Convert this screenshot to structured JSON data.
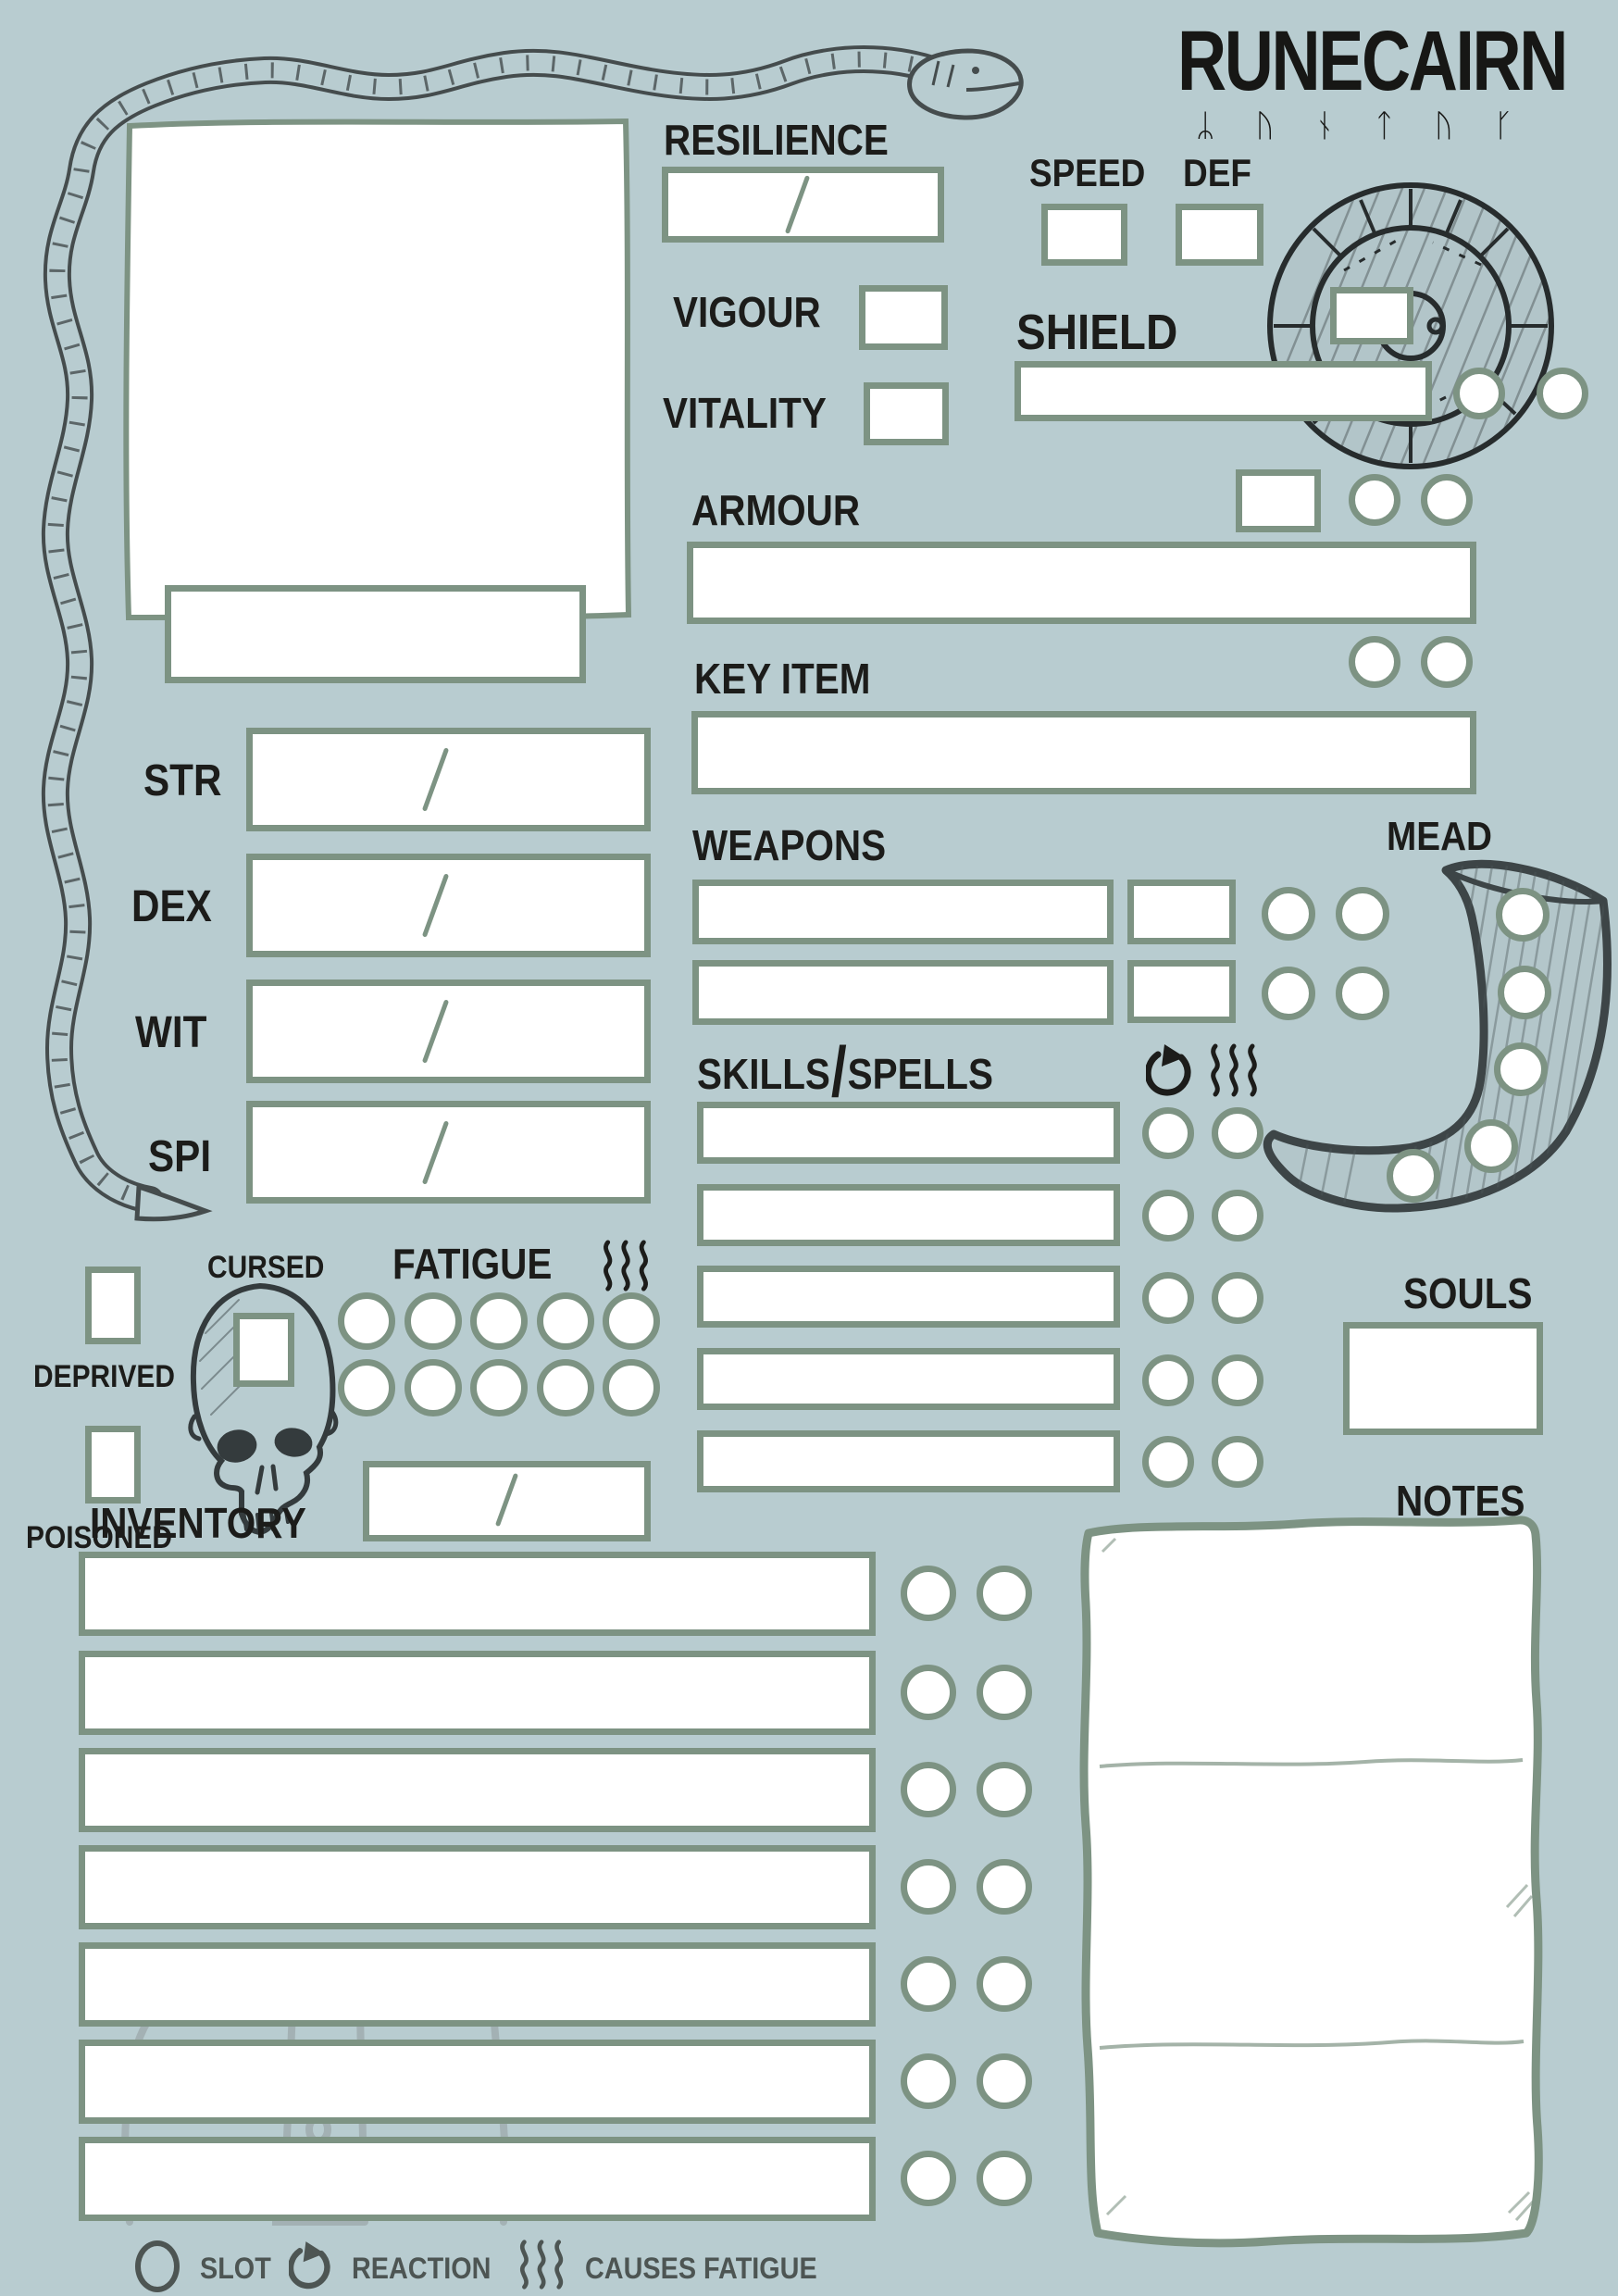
{
  "logo": {
    "title": "RUNECAIRN",
    "runes": "ᛦᚢᚾᛏᚢᚴ"
  },
  "fields": {
    "resilience": "RESILIENCE",
    "speed": "SPEED",
    "def": "DEF",
    "vigour": "VIGOUR",
    "vitality": "VITALITY",
    "shield": "SHIELD",
    "armour": "ARMOUR",
    "key_item": "KEY ITEM",
    "weapons": "WEAPONS",
    "mead": "MEAD",
    "skills_left": "SKILLS",
    "skills_slash": "/",
    "skills_right": "SPELLS",
    "souls": "SOULS",
    "notes": "NOTES",
    "inventory": "INVENTORY",
    "fatigue": "FATIGUE"
  },
  "stats": [
    {
      "label": "STR"
    },
    {
      "label": "DEX"
    },
    {
      "label": "WIT"
    },
    {
      "label": "SPI"
    }
  ],
  "status": {
    "cursed": "CURSED",
    "deprived": "DEPRIVED",
    "poisoned": "POISONED"
  },
  "legend": {
    "slot": "SLOT",
    "reaction": "REACTION",
    "causes_fatigue": "CAUSES FATIGUE"
  },
  "structure": {
    "weapon_rows": 2,
    "skill_rows": 5,
    "inventory_rows": 7,
    "fatigue_slots": 10,
    "mead_slots": 5
  },
  "colors": {
    "background": "#b8ccd0",
    "field_border_green": "#7d9383",
    "ink_black": "#1c1c1a",
    "sketch_dark": "#3c4446",
    "legend_gray": "#4d5553",
    "field_white": "#ffffff"
  },
  "values": {
    "resilience": "",
    "speed": "",
    "def": "",
    "vigour": "",
    "vitality": "",
    "shield": "",
    "armour": "",
    "key_item": "",
    "souls": "",
    "notes": "",
    "name": ""
  }
}
